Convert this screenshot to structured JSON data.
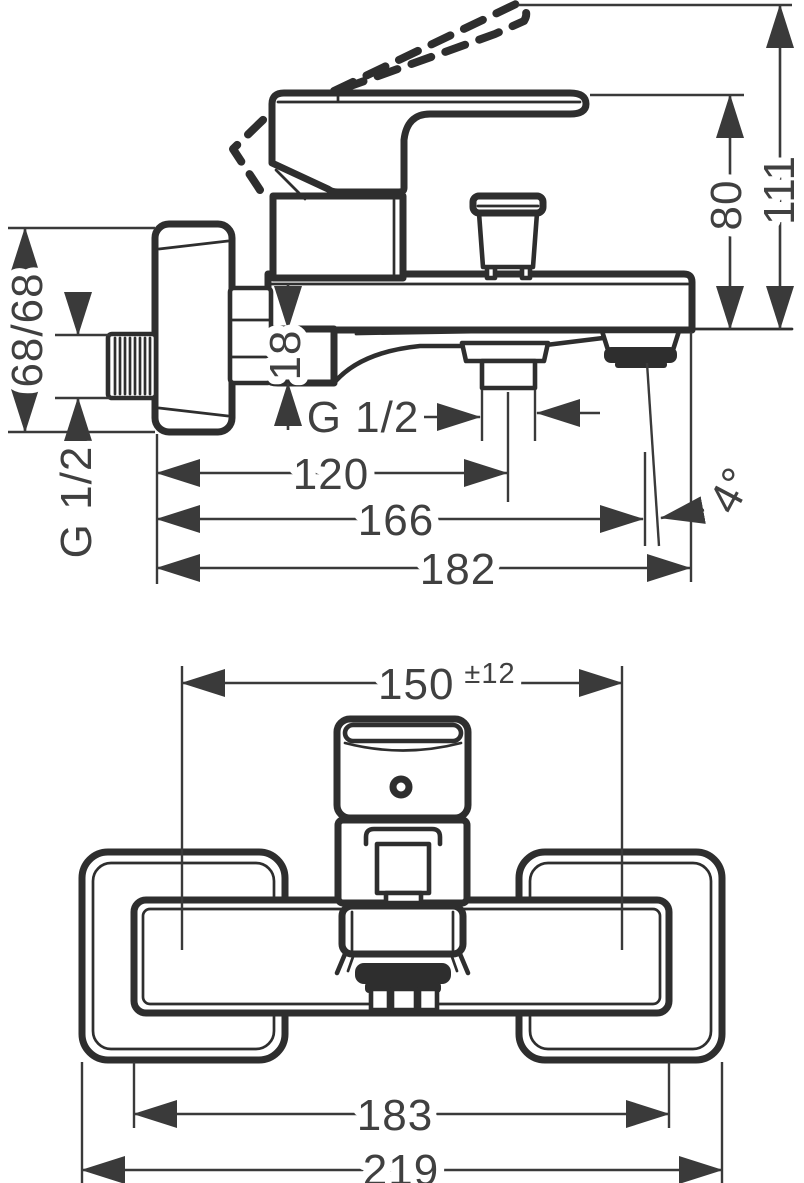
{
  "drawing": {
    "type": "technical-dimension-drawing",
    "product": "wall-mounted bath mixer, side view and plan view",
    "colors": {
      "line": "#2e2e2e",
      "dimension": "#3a3a3a",
      "text": "#404040",
      "background": "#ffffff"
    },
    "side_view": {
      "dim_height_total": "111",
      "dim_height_handle": "80",
      "dim_escutcheon": "68/68",
      "dim_inlet_thread": "G 1/2",
      "dim_spout_offset": "18",
      "dim_outlet_thread": "G 1/2",
      "dim_depth_outlet": "120",
      "dim_depth_aerator": "166",
      "dim_depth_total": "182",
      "dim_spout_angle": "4°"
    },
    "plan_view": {
      "dim_connection_distance": "150",
      "dim_connection_tolerance": "±12",
      "dim_body_width": "183",
      "dim_total_width": "219"
    }
  }
}
